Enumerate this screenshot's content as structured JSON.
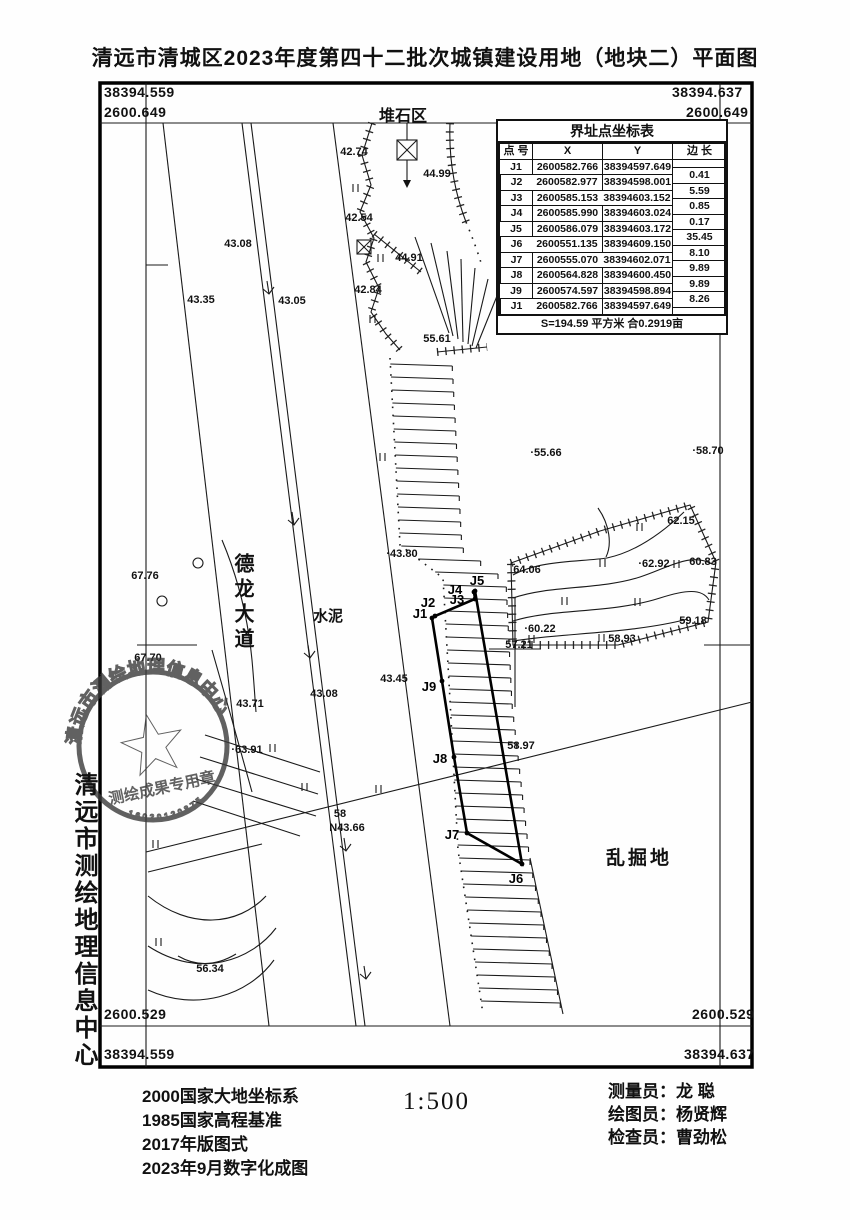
{
  "title": "清远市清城区2023年度第四十二批次城镇建设用地（地块二）平面图",
  "frame": {
    "top_left_easting": "38394.559",
    "top_right_easting": "38394.637",
    "top_northing": "2600.649",
    "bottom_northing": "2600.529",
    "bottom_left_easting": "38394.559",
    "bottom_right_easting": "38394.637"
  },
  "coordinate_table": {
    "title": "界址点坐标表",
    "headers": [
      "点 号",
      "X",
      "Y",
      "边 长"
    ],
    "rows": [
      {
        "p": "J1",
        "x": "2600582.766",
        "y": "38394597.649"
      },
      {
        "p": "J2",
        "x": "2600582.977",
        "y": "38394598.001"
      },
      {
        "p": "J3",
        "x": "2600585.153",
        "y": "38394603.152"
      },
      {
        "p": "J4",
        "x": "2600585.990",
        "y": "38394603.024"
      },
      {
        "p": "J5",
        "x": "2600586.079",
        "y": "38394603.172"
      },
      {
        "p": "J6",
        "x": "2600551.135",
        "y": "38394609.150"
      },
      {
        "p": "J7",
        "x": "2600555.070",
        "y": "38394602.071"
      },
      {
        "p": "J8",
        "x": "2600564.828",
        "y": "38394600.450"
      },
      {
        "p": "J9",
        "x": "2600574.597",
        "y": "38394598.894"
      },
      {
        "p": "J1",
        "x": "2600582.766",
        "y": "38394597.649"
      }
    ],
    "side_lengths": [
      "0.41",
      "5.59",
      "0.85",
      "0.17",
      "35.45",
      "8.10",
      "9.89",
      "9.89",
      "8.26"
    ],
    "area_note": "S=194.59 平方米 合0.2919亩"
  },
  "map": {
    "region_labels": {
      "pile": "堆石区",
      "road": "德龙大道",
      "cement": "水泥",
      "excavated": "乱掘地"
    },
    "spot_elevations": [
      {
        "t": "42.74",
        "x": 354,
        "y": 151
      },
      {
        "t": "44.99",
        "x": 437,
        "y": 173
      },
      {
        "t": "42.54",
        "x": 359,
        "y": 217
      },
      {
        "t": "44.91",
        "x": 409,
        "y": 257
      },
      {
        "t": "43.08",
        "x": 238,
        "y": 243
      },
      {
        "t": "43.35",
        "x": 201,
        "y": 299
      },
      {
        "t": "43.05",
        "x": 292,
        "y": 300
      },
      {
        "t": "42.84",
        "x": 368,
        "y": 289
      },
      {
        "t": "55.61",
        "x": 437,
        "y": 338
      },
      {
        "t": "·55.66",
        "x": 546,
        "y": 452
      },
      {
        "t": "·58.70",
        "x": 708,
        "y": 450
      },
      {
        "t": "·43.80",
        "x": 402,
        "y": 553
      },
      {
        "t": "67.76",
        "x": 145,
        "y": 575
      },
      {
        "t": "67.70",
        "x": 148,
        "y": 657
      },
      {
        "t": "43.71",
        "x": 250,
        "y": 703
      },
      {
        "t": "43.08",
        "x": 324,
        "y": 693
      },
      {
        "t": "·63.91",
        "x": 247,
        "y": 749
      },
      {
        "t": "43.45",
        "x": 394,
        "y": 678
      },
      {
        "t": "64.06",
        "x": 527,
        "y": 569
      },
      {
        "t": "62.15",
        "x": 681,
        "y": 520
      },
      {
        "t": "·62.92",
        "x": 654,
        "y": 563
      },
      {
        "t": "60.83",
        "x": 703,
        "y": 561
      },
      {
        "t": "·60.22",
        "x": 540,
        "y": 628
      },
      {
        "t": "59.18",
        "x": 693,
        "y": 620
      },
      {
        "t": "58.93",
        "x": 622,
        "y": 638
      },
      {
        "t": "57.21",
        "x": 519,
        "y": 644
      },
      {
        "t": "58.97",
        "x": 521,
        "y": 745
      },
      {
        "t": "56.34",
        "x": 210,
        "y": 968
      },
      {
        "t": "58",
        "x": 340,
        "y": 813
      },
      {
        "t": "N43.66",
        "x": 347,
        "y": 827
      }
    ],
    "boundary_points": [
      {
        "label": "J1",
        "x": 432,
        "y": 618,
        "lx": 420,
        "ly": 614
      },
      {
        "label": "J2",
        "x": 435,
        "y": 616,
        "lx": 428,
        "ly": 603
      },
      {
        "label": "J3",
        "x": 475,
        "y": 599,
        "lx": 457,
        "ly": 600
      },
      {
        "label": "J4",
        "x": 474,
        "y": 592,
        "lx": 455,
        "ly": 590
      },
      {
        "label": "J5",
        "x": 475,
        "y": 591,
        "lx": 477,
        "ly": 581
      },
      {
        "label": "J6",
        "x": 522,
        "y": 864,
        "lx": 516,
        "ly": 879
      },
      {
        "label": "J7",
        "x": 467,
        "y": 833,
        "lx": 452,
        "ly": 835
      },
      {
        "label": "J8",
        "x": 454,
        "y": 757,
        "lx": 440,
        "ly": 759
      },
      {
        "label": "J9",
        "x": 442,
        "y": 681,
        "lx": 429,
        "ly": 687
      }
    ],
    "grass_symbols": [
      [
        353,
        184
      ],
      [
        378,
        254
      ],
      [
        370,
        315
      ],
      [
        380,
        453
      ],
      [
        302,
        783
      ],
      [
        376,
        785
      ],
      [
        270,
        744
      ],
      [
        153,
        840
      ],
      [
        156,
        938
      ],
      [
        637,
        523
      ],
      [
        600,
        559
      ],
      [
        674,
        560
      ],
      [
        562,
        597
      ],
      [
        635,
        598
      ],
      [
        529,
        635
      ],
      [
        599,
        634
      ]
    ],
    "flow_arrows": [
      [
        267,
        281
      ],
      [
        292,
        512
      ],
      [
        308,
        645
      ],
      [
        344,
        838
      ],
      [
        364,
        966
      ]
    ]
  },
  "stamp": {
    "ring_text": "清远市测绘地理信息中心",
    "banner_text": "测绘成果专用章",
    "serial": "16020120875"
  },
  "side_caption": "清远市测绘地理信息中心",
  "footer": {
    "notes": [
      "2000国家大地坐标系",
      "1985国家高程基准",
      "2017年版图式",
      "2023年9月数字化成图"
    ],
    "scale": "1:500",
    "credits": [
      "测量员：龙  聪",
      "绘图员：杨贤辉",
      "检查员：曹劲松"
    ]
  }
}
